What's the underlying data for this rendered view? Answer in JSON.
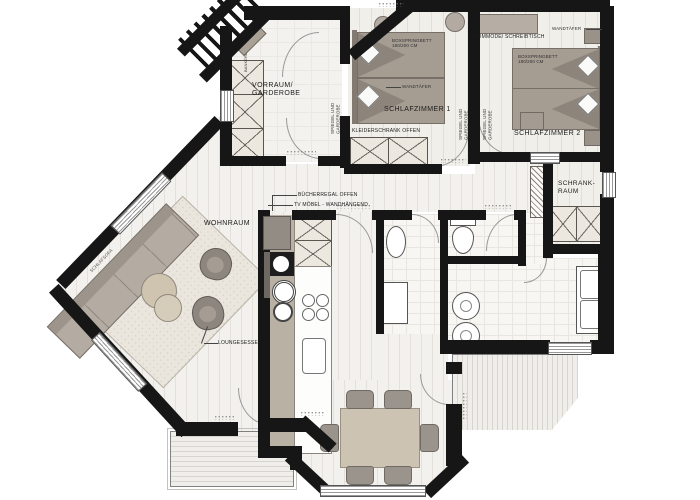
{
  "plan": {
    "type": "apartment-floor-plan",
    "rooms": {
      "vorraum": {
        "label": "VORRAUM/\nGARDEROBE"
      },
      "schlafzimmer1": {
        "label": "SCHLAFZIMMER 1"
      },
      "schlafzimmer2": {
        "label": "SCHLAFZIMMER 2"
      },
      "schrankraum": {
        "label": "SCHRANK-\nRAUM"
      },
      "wohnraum": {
        "label": "WOHNRAUM"
      }
    },
    "annotations": {
      "buecherregal": "BÜCHERREGAL OFFEN",
      "tv_moebel": "TV MÖBEL - WANDHÄNGEND",
      "loungesessel": "LOUNGESESSEL",
      "kleiderschrank": "KLEIDERSCHRANK OFFEN",
      "spiegel_garderobe": "SPIEGEL UND GARDEROBE",
      "kommode_schreibtisch": "KOMMODE/ SCHREIBTISCH",
      "wandtaefer": "WANDTÄFER",
      "boxspringbett": "BOXSPRINGBETT\n180/200 CM",
      "schlafsofa": "SCHLAFSOFA",
      "bankerl": "BANKERL"
    },
    "colors": {
      "wall": "#161616",
      "floor": "#f3f1ed",
      "furniture_gray": "#a59c92",
      "furniture_dark": "#8d857b",
      "table_beige": "#cdc3b2",
      "carpet": "#eae6de"
    }
  }
}
